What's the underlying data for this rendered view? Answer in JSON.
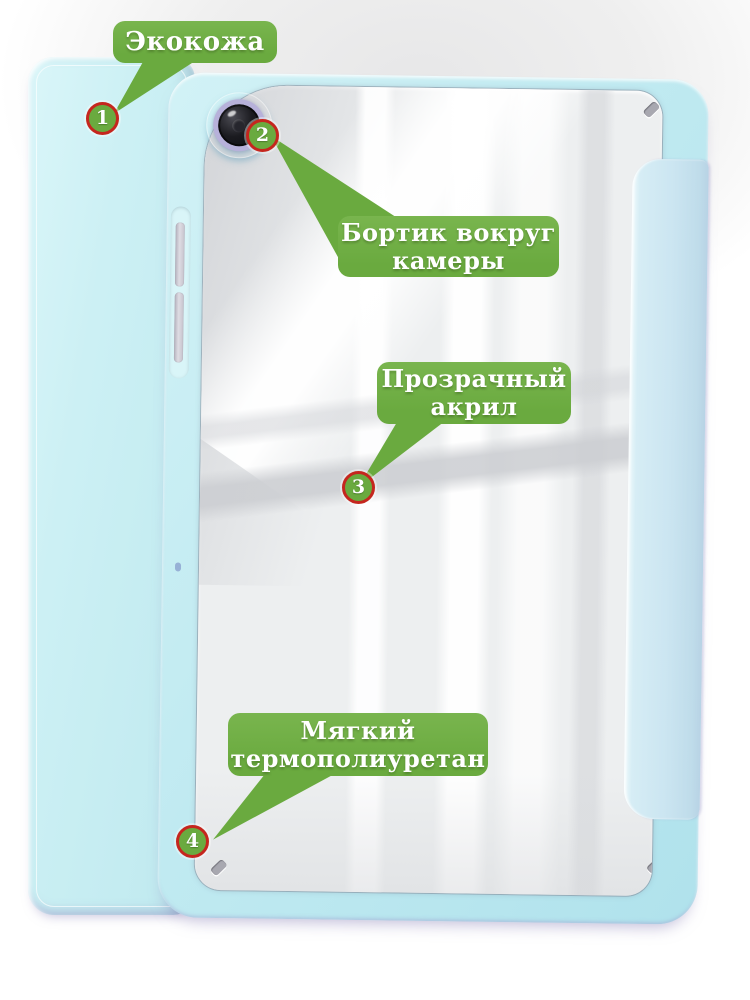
{
  "callouts": [
    {
      "number": "1",
      "label": "Экокожа",
      "lines": [
        "Экокожа"
      ]
    },
    {
      "number": "2",
      "label": "Бортик вокруг камеры",
      "lines": [
        "Бортик вокруг",
        "камеры"
      ]
    },
    {
      "number": "3",
      "label": "Прозрачный акрил",
      "lines": [
        "Прозрачный",
        "акрил"
      ]
    },
    {
      "number": "4",
      "label": "Мягкий термополиуретан",
      "lines": [
        "Мягкий",
        "термополиуретан"
      ]
    }
  ],
  "colors": {
    "green": "#6aaa3f",
    "ring_red": "#c5261e",
    "case_cyan": "#c0eaf1",
    "cover_cyan": "#bfe9ef",
    "flap_blue": "#cbe5f1",
    "acrylic_gray": "#edeff0",
    "camera_ring": "#b7b1da"
  }
}
